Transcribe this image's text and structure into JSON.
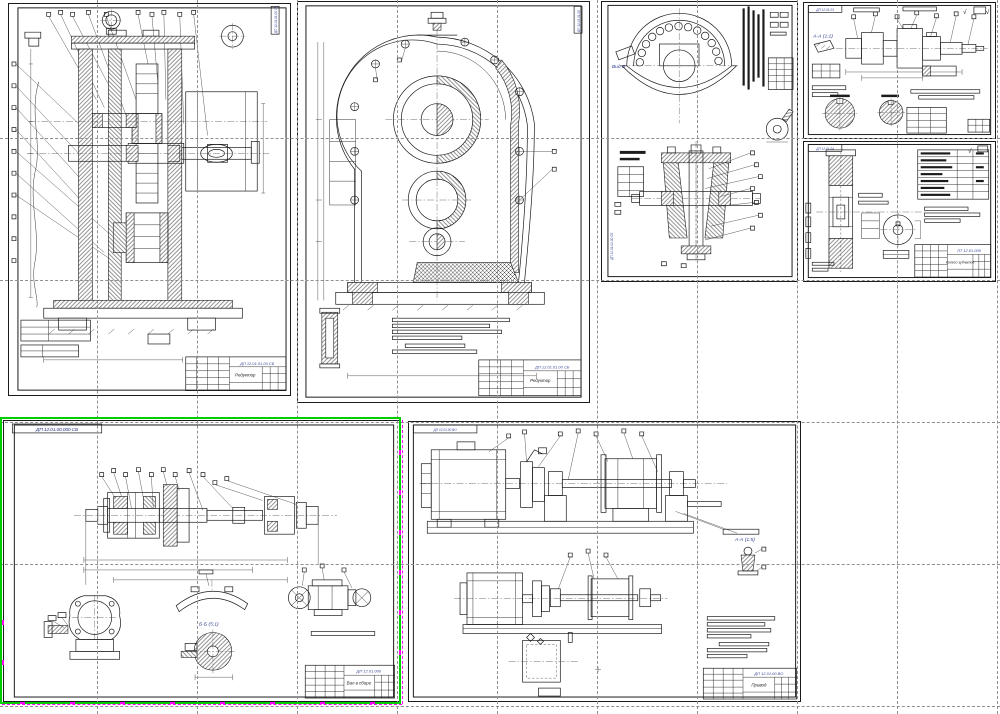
{
  "app": {
    "background": "#ffffff",
    "grid_color": "#8f8f8f",
    "selection_color": "#00cd00",
    "grip_color": "#ff00ff",
    "line_color": "#1b1b1b",
    "accent_blue": "#3a4a9c"
  },
  "sheets": {
    "reducer_section": {
      "title_doc": "ДП 12.01.01.00 СБ",
      "title_name": "Редуктор",
      "side_doc": "ДП 12.01.01.00 СБ"
    },
    "reducer_cover": {
      "title_doc": "ДП 12.01.01.00 СБ",
      "title_name": "Редуктор",
      "side_doc": "ДП 12.01.01.00"
    },
    "wheel_assembly": {
      "view_label": "Вид Б",
      "side_doc": "ДП 12.01.02.00 СБ"
    },
    "shaft_drawing": {
      "corner_doc": "ДП 12.01.03",
      "section_label": "А-А (1:1)",
      "roughness_mark": "√"
    },
    "gear_wheel": {
      "corner_doc": "ДП 12.01.04",
      "roughness_mark": "√",
      "title_doc": "ЛТ 12.01.005",
      "title_name": "Колесо зубчатое"
    },
    "selected_shaft_assembly": {
      "corner_doc": "ДП 12.01.00.000 СБ",
      "section_label": "Б-Б (5:1)",
      "title_doc": "ДП 12.01.000",
      "title_name": "Вал в сборе"
    },
    "drive_layout": {
      "corner_doc": "ДП 12.01.00 ВО",
      "detail_label": "А-А (1:5)",
      "title_doc": "ДП 12.01.00 ВО",
      "title_name": "Привод"
    }
  }
}
